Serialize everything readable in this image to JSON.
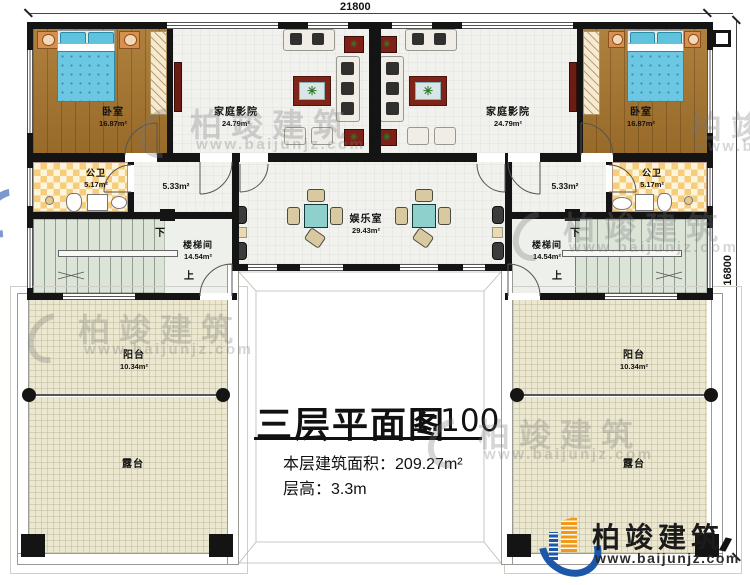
{
  "dimensions": {
    "top": "21800",
    "right": "16800"
  },
  "labels": {
    "bedroom": "卧室",
    "bedroom_area": "16.87m²",
    "theater": "家庭影院",
    "theater_area": "24.79m²",
    "bath": "公卫",
    "bath_area": "5.17m²",
    "hall_area": "5.33m²",
    "rec": "娱乐室",
    "rec_area": "29.43m²",
    "stair": "楼梯间",
    "stair_area": "14.54m²",
    "balcony": "阳台",
    "balcony_area": "10.34m²",
    "terrace": "露台",
    "up": "上",
    "down": "下"
  },
  "title_block": {
    "title": "三层平面图",
    "scale": "1:100",
    "area_label": "本层建筑面积：",
    "area_value": "209.27m²",
    "height_label": "层高：",
    "height_value": "3.3m"
  },
  "branding": {
    "name": "柏竣建筑",
    "url": "www.baijunjz.com"
  },
  "watermark": {
    "name": "柏竣建筑",
    "url": "www.baijunjz.com"
  },
  "colors": {
    "wall": "#141414",
    "wood_floor": "#a8762e",
    "bath_tile": "#f5cd7c",
    "stair_floor": "#dce4d8",
    "outdoor_floor": "#ebe7d0",
    "table_teal": "#8ed0cc",
    "cabinet_red": "#7e2418",
    "logo_blue": "#1c57aa",
    "logo_orange": "#f09a1c"
  }
}
